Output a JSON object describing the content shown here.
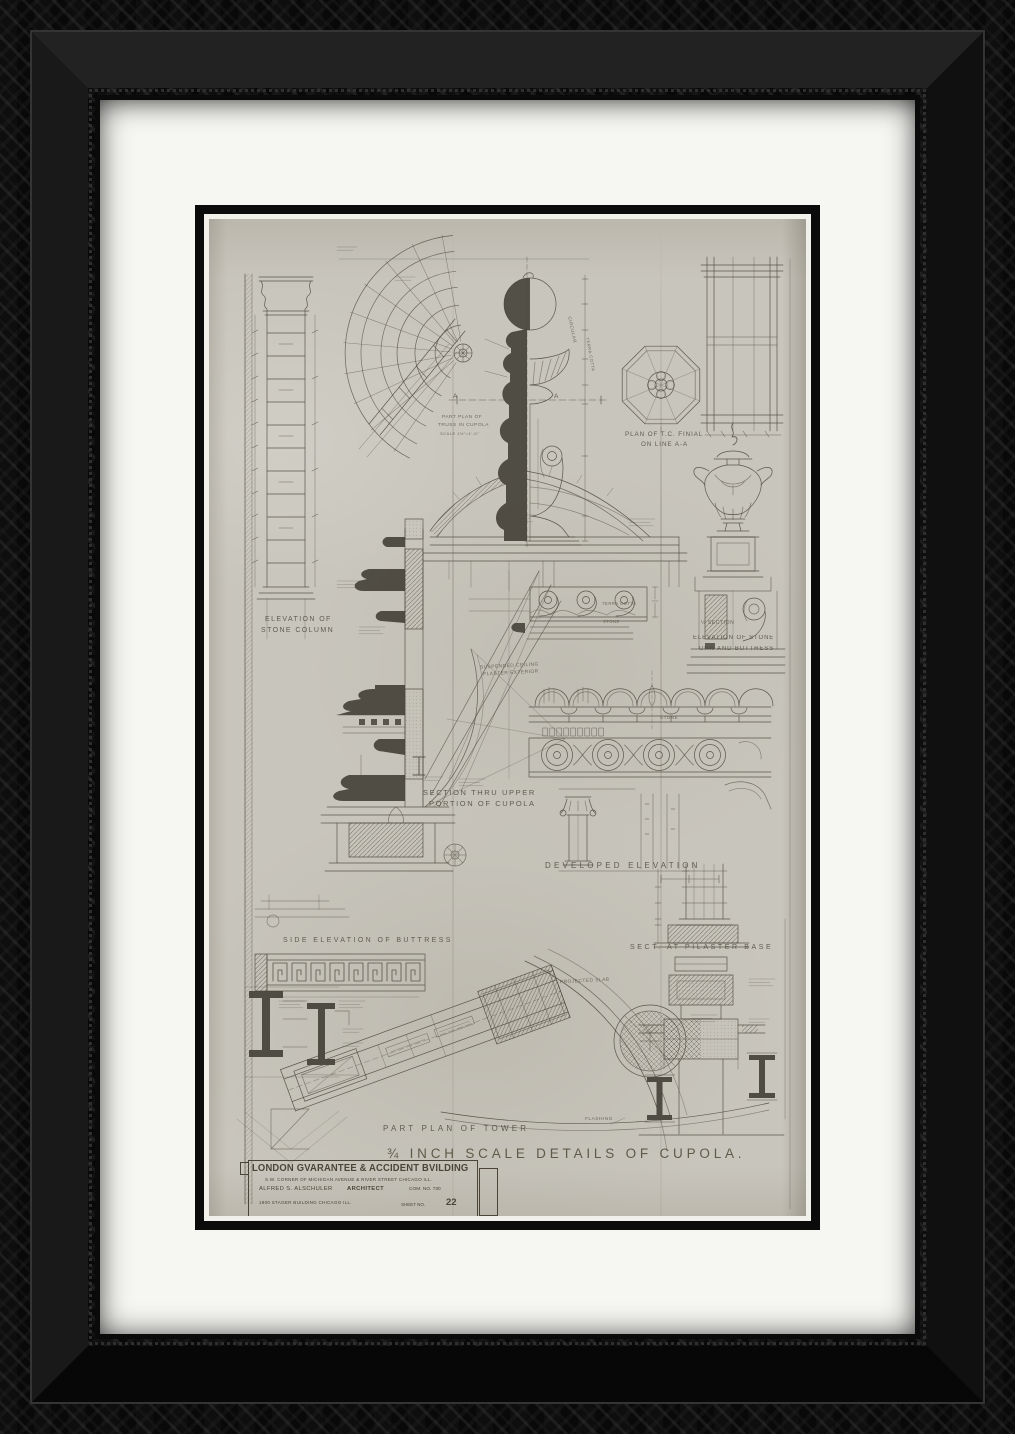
{
  "frame": {
    "material": "ornate-carved-wood",
    "color": "#0b0b0b",
    "mat_color": "#f6f6f3"
  },
  "artwork": {
    "paper_color": "#c8c5bc",
    "ink_color": "#504b40",
    "drawing_title": "¾ INCH SCALE DETAILS OF CUPOLA.",
    "labels": {
      "part_plan_truss_1": "PART PLAN OF",
      "part_plan_truss_2": "TRUSS IN CUPOLA",
      "part_plan_truss_3": "SCALE 1½\"=1'-0\"",
      "plan_finial_1": "PLAN OF T.C. FINIAL",
      "plan_finial_2": "ON LINE A-A",
      "mark_a_left": "A",
      "mark_a_right": "A",
      "circular": "CIRCULAR",
      "terra_cotta_v": "TERRA COTTA",
      "elev_column_1": "ELEVATION OF",
      "elev_column_2": "STONE COLUMN",
      "half_section": "½ SECTION",
      "elev_urn_1": "ELEVATION OF STONE",
      "elev_urn_2": "URN AND BUTTRESS",
      "terra_cotta": "TERRA COTTA",
      "stone": "STONE",
      "stone_2": "STONE",
      "suspended_ceiling_1": "SUSPENDED CEILING",
      "suspended_ceiling_2": "PLASTER EXTERIOR",
      "section_upper_1": "SECTION THRU UPPER",
      "section_upper_2": "PORTION OF CUPOLA",
      "developed_elevation": "DEVELOPED ELEVATION",
      "side_elev_buttress": "SIDE ELEVATION OF BUTTRESS",
      "sect_pilaster_base": "SECT. AT PILASTER BASE",
      "projected_slab": "PROJECTED SLAB",
      "flashing": "FLASHING",
      "part_plan_tower": "PART PLAN OF TOWER"
    },
    "title_block": {
      "building": "LONDON GVARANTEE & ACCIDENT BVILDING",
      "address": "S.W. CORNER OF MICHIGAN AVENUE & RIVER STREET CHICAGO ILL.",
      "architect": "ALFRED S. ALSCHULER",
      "architect_title": "ARCHITECT",
      "commission": "COM. NO. 730",
      "office": "1900 STAGER BUILDING  CHICAGO ILL.",
      "sheet_label": "SHEET NO.",
      "sheet_number": "22"
    }
  }
}
